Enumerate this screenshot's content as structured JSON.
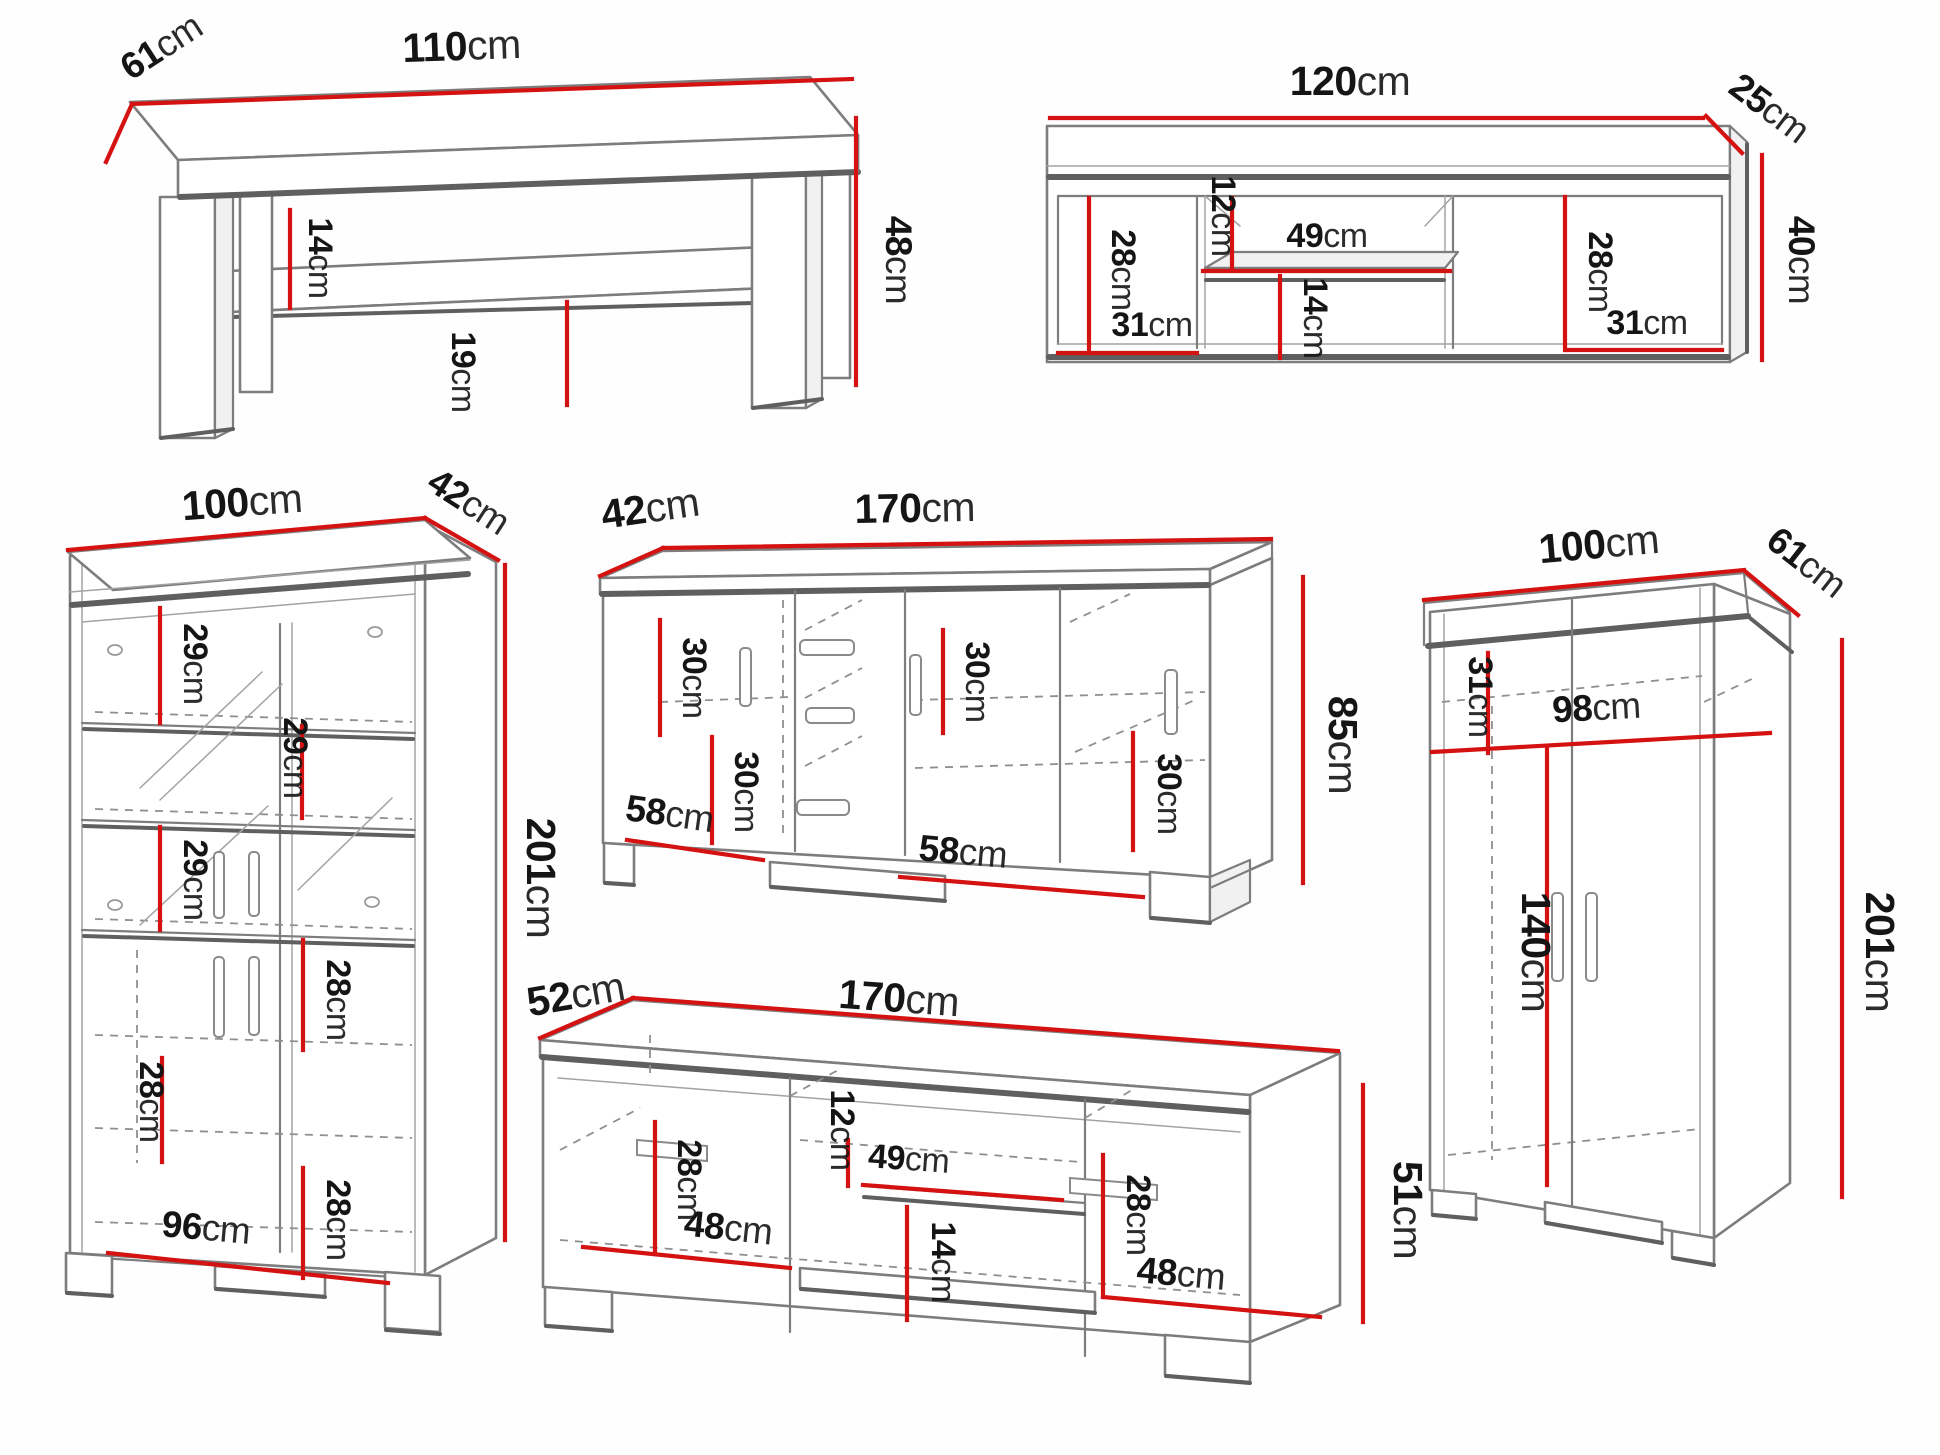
{
  "palette": {
    "dimension_line_red": "#d51212",
    "outline_gray": "#7d7d7d",
    "shadow_gray": "#5f5f5f",
    "label_black": "#151515",
    "background": "#fefefe"
  },
  "figures": {
    "coffee_table": {
      "dims": {
        "depth": {
          "value": "61",
          "unit": "cm"
        },
        "width": {
          "value": "110",
          "unit": "cm"
        },
        "shelf_clearance": {
          "value": "14",
          "unit": "cm"
        },
        "height": {
          "value": "48",
          "unit": "cm"
        },
        "shelf_height": {
          "value": "19",
          "unit": "cm"
        }
      }
    },
    "wall_shelf": {
      "dims": {
        "width": {
          "value": "120",
          "unit": "cm"
        },
        "depth": {
          "value": "25",
          "unit": "cm"
        },
        "height": {
          "value": "40",
          "unit": "cm"
        },
        "left_inner_height": {
          "value": "28",
          "unit": "cm"
        },
        "left_inner_width": {
          "value": "31",
          "unit": "cm"
        },
        "top_gap": {
          "value": "12",
          "unit": "cm"
        },
        "niche_width": {
          "value": "49",
          "unit": "cm"
        },
        "niche_height": {
          "value": "14",
          "unit": "cm"
        },
        "right_inner_height": {
          "value": "28",
          "unit": "cm"
        },
        "right_inner_width": {
          "value": "31",
          "unit": "cm"
        }
      }
    },
    "display_cabinet": {
      "dims": {
        "width": {
          "value": "100",
          "unit": "cm"
        },
        "depth": {
          "value": "42",
          "unit": "cm"
        },
        "height": {
          "value": "201",
          "unit": "cm"
        },
        "shelf_1": {
          "value": "29",
          "unit": "cm"
        },
        "shelf_2": {
          "value": "29",
          "unit": "cm"
        },
        "shelf_3": {
          "value": "29",
          "unit": "cm"
        },
        "section_4": {
          "value": "28",
          "unit": "cm"
        },
        "section_5": {
          "value": "28",
          "unit": "cm"
        },
        "section_6": {
          "value": "28",
          "unit": "cm"
        },
        "base_width": {
          "value": "96",
          "unit": "cm"
        }
      }
    },
    "sideboard": {
      "dims": {
        "depth": {
          "value": "42",
          "unit": "cm"
        },
        "width": {
          "value": "170",
          "unit": "cm"
        },
        "height": {
          "value": "85",
          "unit": "cm"
        },
        "left_top": {
          "value": "30",
          "unit": "cm"
        },
        "left_bottom": {
          "value": "30",
          "unit": "cm"
        },
        "right_top": {
          "value": "30",
          "unit": "cm"
        },
        "right_bottom": {
          "value": "30",
          "unit": "cm"
        },
        "left_door_width": {
          "value": "58",
          "unit": "cm"
        },
        "right_door_width": {
          "value": "58",
          "unit": "cm"
        }
      }
    },
    "tv_stand": {
      "dims": {
        "depth": {
          "value": "52",
          "unit": "cm"
        },
        "width": {
          "value": "170",
          "unit": "cm"
        },
        "height": {
          "value": "51",
          "unit": "cm"
        },
        "left_inner_height": {
          "value": "28",
          "unit": "cm"
        },
        "left_door_width": {
          "value": "48",
          "unit": "cm"
        },
        "top_gap": {
          "value": "12",
          "unit": "cm"
        },
        "niche_width": {
          "value": "49",
          "unit": "cm"
        },
        "niche_height": {
          "value": "14",
          "unit": "cm"
        },
        "right_inner_height": {
          "value": "28",
          "unit": "cm"
        },
        "right_door_width": {
          "value": "48",
          "unit": "cm"
        }
      }
    },
    "wardrobe": {
      "dims": {
        "width": {
          "value": "100",
          "unit": "cm"
        },
        "depth": {
          "value": "61",
          "unit": "cm"
        },
        "top_section_height": {
          "value": "31",
          "unit": "cm"
        },
        "inner_width": {
          "value": "98",
          "unit": "cm"
        },
        "door_height": {
          "value": "140",
          "unit": "cm"
        },
        "height": {
          "value": "201",
          "unit": "cm"
        }
      }
    }
  }
}
